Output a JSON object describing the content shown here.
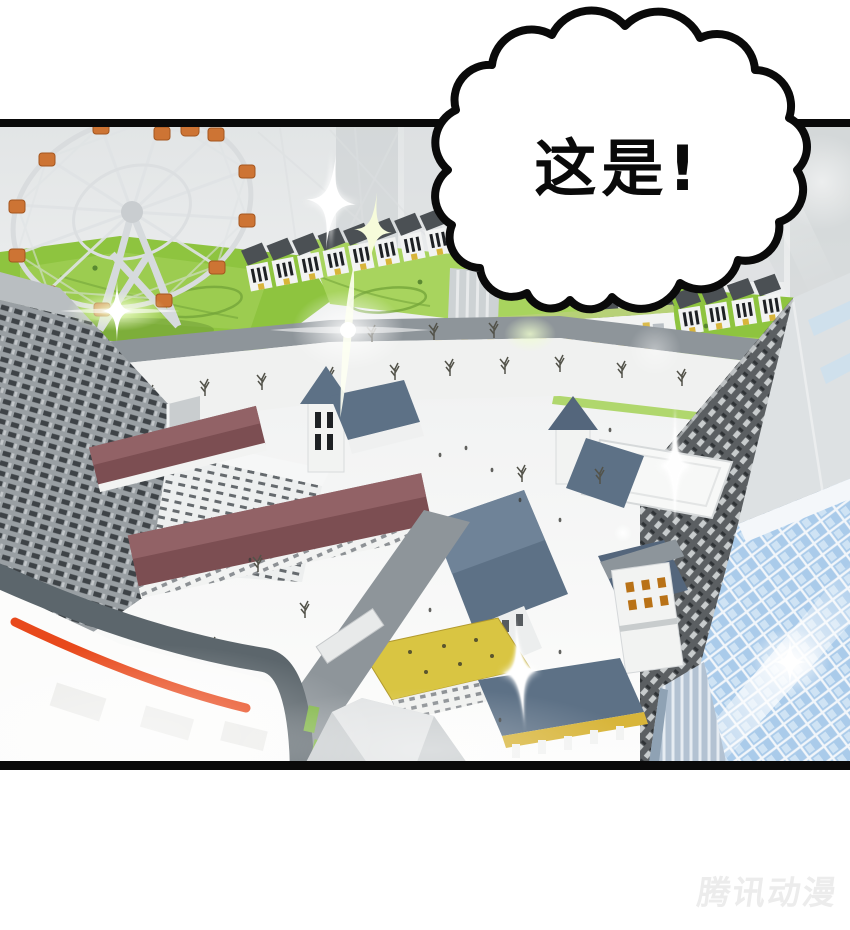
{
  "page": {
    "background": "#ffffff"
  },
  "panel": {
    "border_color": "#000000"
  },
  "speech_bubble": {
    "text": "这是!",
    "fill": "#ffffff",
    "outline": "#000000"
  },
  "watermark": {
    "text": "腾讯动漫",
    "color": "#ececec"
  },
  "scene": {
    "description": "Aerial isometric 3D city: ferris wheel in a green amusement park, terraced rowhouses, European-style blocks with maroon and slate-blue roofs, white plazas with bare trees, dark high-rise towers, a blue glass skyscraper with lens flare, a white rooftop crossed by an orange stripe, and white sparkles.",
    "elements": [
      "ferris-wheel",
      "amusement-park",
      "rowhouses",
      "yellow-accent-building",
      "plaza",
      "church-steeple",
      "maroon-roof-blocks",
      "slate-roof-halls",
      "yellow-roof-deck",
      "clock-tower",
      "dark-skyscraper",
      "glass-skyscraper",
      "rooftop-orange-stripe",
      "sparkles",
      "lens-flares"
    ],
    "colors": {
      "ink": "#0a0a0a",
      "paper": "#ffffff",
      "green": "#8ec43f",
      "greenlight": "#a8d45e",
      "greendark": "#6f9c37",
      "parkpath": "#74a53a",
      "street": "#8e959a",
      "plaza": "#f0f1f0",
      "wall": "#f2f3f2",
      "roofdark": "#4b5054",
      "maroon": "#7c4e52",
      "roofblue": "#5d7186",
      "towerleft": "#9aa0a4",
      "towerdark": "#5a5e61",
      "glass": "#a9c9e9",
      "gondola": "#cd7434",
      "gondoladark": "#a4561f",
      "stripe": "#e8491c",
      "yellow": "#d8b53a",
      "deckyellow": "#d9c542",
      "sparkle": "#ffffff",
      "watermark": "#ececec"
    }
  }
}
